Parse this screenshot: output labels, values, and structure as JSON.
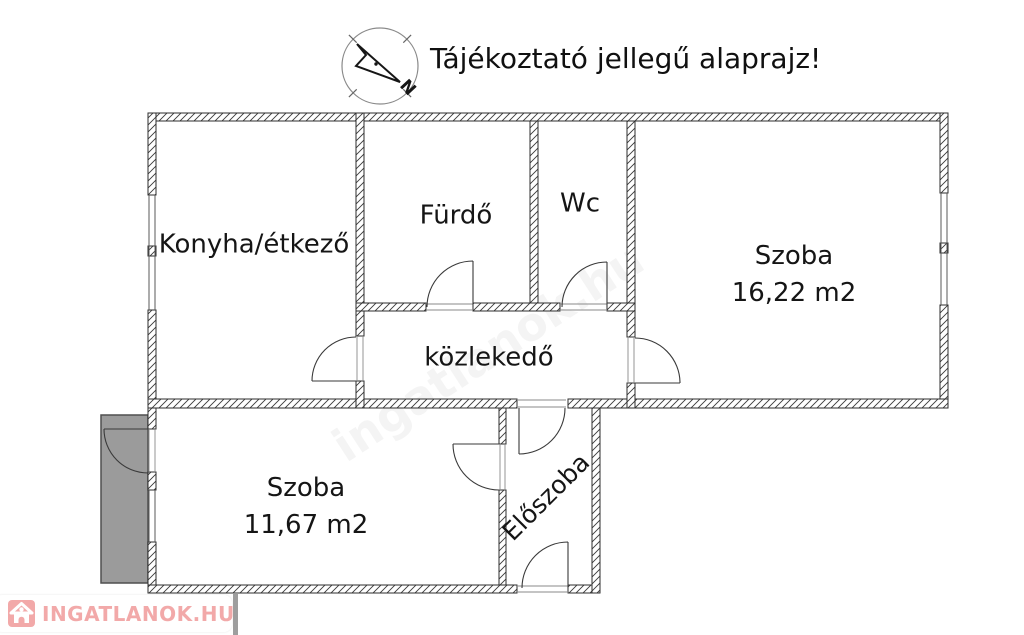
{
  "title": "Tájékoztató jellegű alaprajz!",
  "compass": {
    "north_label": "N"
  },
  "rooms": {
    "kitchen": {
      "label": "Konyha/étkező"
    },
    "bathroom": {
      "label": "Fürdő"
    },
    "wc": {
      "label": "Wc"
    },
    "room_large": {
      "label": "Szoba",
      "area": "16,22 m2"
    },
    "hallway": {
      "label": "közlekedő"
    },
    "room_small": {
      "label": "Szoba",
      "area": "11,67 m2"
    },
    "entrance": {
      "label": "Előszoba"
    }
  },
  "watermark": {
    "brand": "INGATLANOK.HU",
    "ghost": "ingatlanok.hu"
  },
  "colors": {
    "brand_pink": "#F2A9A9",
    "balcony_gray": "#9B9B9B",
    "wall_outline": "#2E2E2E"
  }
}
